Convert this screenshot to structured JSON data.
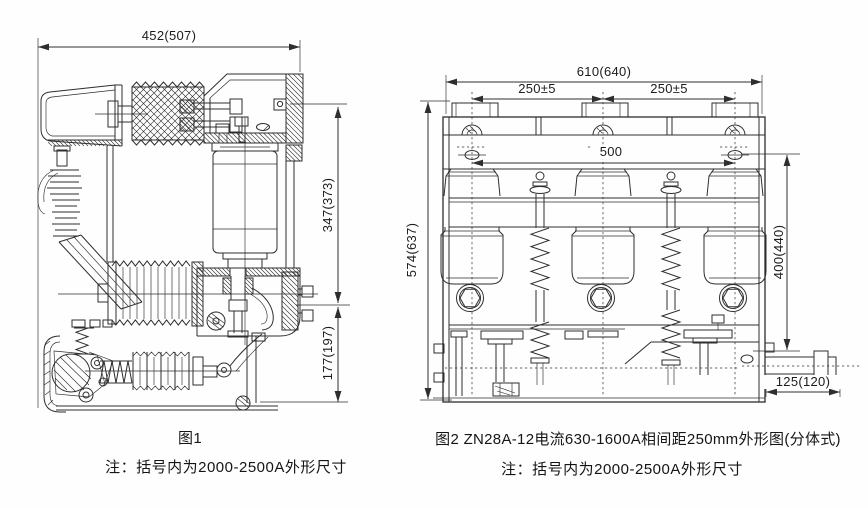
{
  "page": {
    "ink_color": "#2e2e2e",
    "background": "#fefefe"
  },
  "figure1": {
    "caption": "图1",
    "note": "注：括号内为2000-2500A外形尺寸",
    "dimensions": {
      "overall_width": "452(507)",
      "upper_height": "347(373)",
      "lower_height": "177(197)"
    }
  },
  "figure2": {
    "caption": "图2 ZN28A-12电流630-1600A相间距250mm外形图(分体式)",
    "note": "注：括号内为2000-2500A外形尺寸",
    "dimensions": {
      "overall_width": "610(640)",
      "phase_spacing_left": "250±5",
      "phase_spacing_right": "250±5",
      "mounting_hole_spacing": "500",
      "overall_height": "574(637)",
      "pole_height": "400(440)",
      "shaft_extension": "125(120)"
    }
  }
}
